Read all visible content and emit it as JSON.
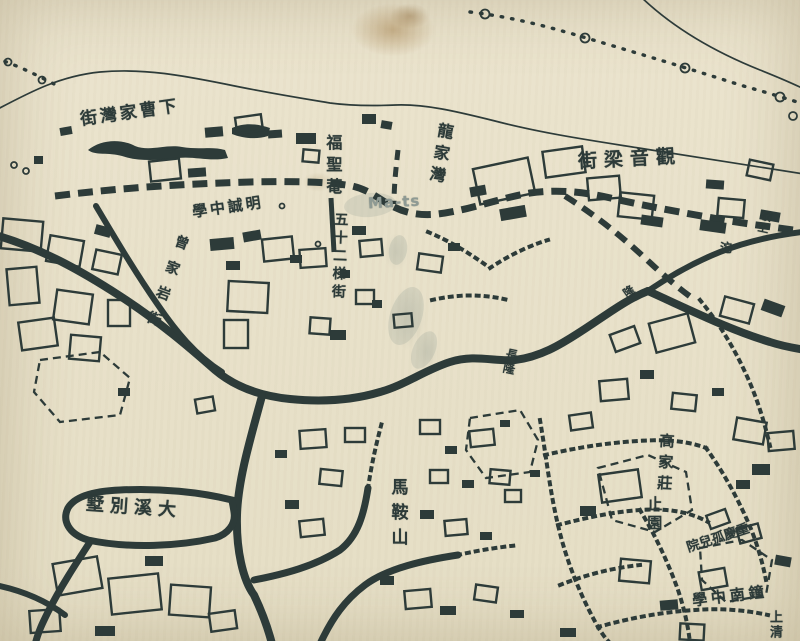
{
  "map": {
    "kind": "historical-city-map",
    "language": "zh-Hant",
    "colors": {
      "paper": "#eae3cc",
      "ink": "#2d3b39",
      "stain": "#926426",
      "watermark": "#8e9a94"
    },
    "labels": [
      {
        "name": "street-label-xiacaojiawan",
        "reading": "下曹家灣街",
        "display": "街灣家曹下",
        "orient": "h",
        "x": 80,
        "y": 104,
        "size": 17,
        "spacing": 3,
        "rot": -8
      },
      {
        "name": "temple-label-fushengan",
        "reading": "福聖菴",
        "orient": "v",
        "x": 323,
        "y": 134,
        "size": 16,
        "spacing": 6,
        "rot": 0
      },
      {
        "name": "place-label-longjiawan",
        "reading": "龍家灣",
        "orient": "v",
        "x": 430,
        "y": 122,
        "size": 16,
        "spacing": 6,
        "rot": 10
      },
      {
        "name": "street-label-guanyinliangjie",
        "reading": "觀音梁街",
        "display": "街梁音觀",
        "orient": "h",
        "x": 578,
        "y": 149,
        "size": 19,
        "spacing": 7,
        "rot": -3
      },
      {
        "name": "school-label-mingcheng",
        "reading": "明誠中學",
        "display": "學中誠明",
        "orient": "h",
        "x": 192,
        "y": 199,
        "size": 15,
        "spacing": 3,
        "rot": -8
      },
      {
        "name": "street-label-zengjiayanjie",
        "reading": "曾家岩街",
        "orient": "v",
        "x": 157,
        "y": 232,
        "size": 14,
        "spacing": 13,
        "rot": 20
      },
      {
        "name": "street-label-wushierti",
        "reading": "五十二梯街",
        "orient": "v",
        "x": 331,
        "y": 212,
        "size": 14,
        "spacing": 4,
        "rot": 2
      },
      {
        "name": "watermark-label-mats",
        "reading": "Ma-ts",
        "orient": "h",
        "x": 368,
        "y": 194,
        "size": 15,
        "spacing": 1,
        "rot": -3,
        "color": "#8e9a94"
      },
      {
        "name": "road-label-changlong",
        "reading": "長隆",
        "orient": "v",
        "x": 502,
        "y": 348,
        "size": 12,
        "spacing": 2,
        "rot": 12
      },
      {
        "name": "road-label-long",
        "reading": "隆",
        "orient": "h",
        "x": 624,
        "y": 286,
        "size": 11,
        "spacing": 0,
        "rot": -35
      },
      {
        "name": "place-label-gaojiazhuang",
        "reading": "高家莊",
        "orient": "v",
        "x": 656,
        "y": 433,
        "size": 15,
        "spacing": 6,
        "rot": 3
      },
      {
        "name": "garden-label-zhiyuan",
        "reading": "止園",
        "orient": "v",
        "x": 645,
        "y": 496,
        "size": 15,
        "spacing": 4,
        "rot": 0
      },
      {
        "name": "orphanage-label-chongqing",
        "reading": "重慶孤兒院",
        "display": "院兒孤慶重",
        "orient": "h",
        "x": 686,
        "y": 532,
        "size": 13,
        "spacing": 0,
        "rot": -18
      },
      {
        "name": "hill-label-maanshan",
        "reading": "馬鞍山",
        "orient": "v",
        "x": 387,
        "y": 478,
        "size": 17,
        "spacing": 8,
        "rot": 0
      },
      {
        "name": "villa-label-daxibieshu",
        "reading": "大溪別墅",
        "display": "墅別溪大",
        "orient": "h",
        "x": 86,
        "y": 498,
        "size": 18,
        "spacing": 6,
        "rot": 4
      },
      {
        "name": "school-label-zhongnan",
        "reading": "鐘南中學",
        "display": "學中南鐘",
        "orient": "h",
        "x": 692,
        "y": 588,
        "size": 15,
        "spacing": 4,
        "rot": -7
      },
      {
        "name": "place-label-shangqing",
        "reading": "上清",
        "orient": "v",
        "x": 766,
        "y": 610,
        "size": 13,
        "spacing": 2,
        "rot": 0
      },
      {
        "name": "place-label-lingshang",
        "reading": "嶺上",
        "orient": "v",
        "x": 757,
        "y": 210,
        "size": 11,
        "spacing": 1,
        "rot": 12
      },
      {
        "name": "place-label-tuo",
        "reading": "沱",
        "orient": "h",
        "x": 720,
        "y": 242,
        "size": 12,
        "spacing": 0,
        "rot": 0
      }
    ]
  }
}
